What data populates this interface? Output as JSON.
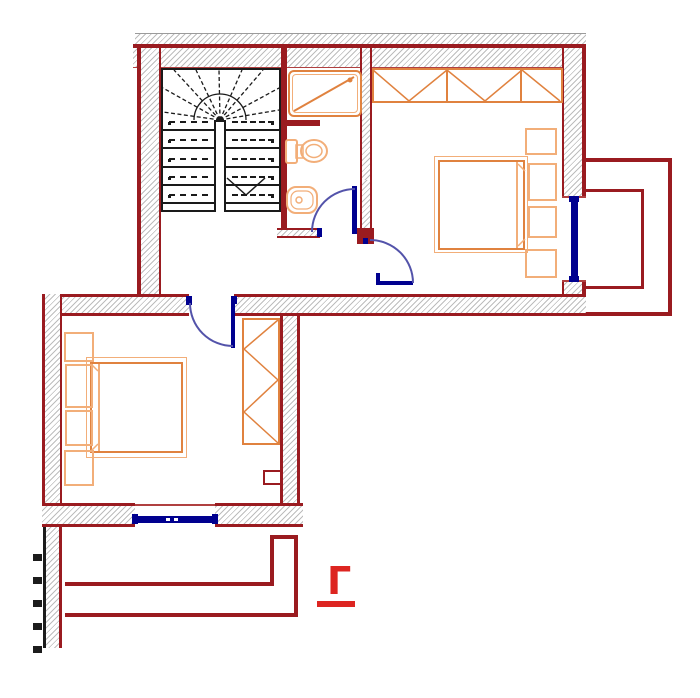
{
  "document": {
    "type": "architectural floor plan drawing",
    "visible_text": [
      "Г"
    ]
  },
  "section_marker": {
    "label": "Г"
  },
  "colors": {
    "wall": "#9a1b20",
    "accent_red": "#dd2521",
    "furniture": "#e0823f",
    "furniture_light": "#f2ae79",
    "window": "#00008f",
    "door_arc": "#5353aa",
    "hatch_line": "#bdbdbd",
    "stair": "#1a1a1a",
    "background": "#ffffff"
  },
  "stairs": {
    "treads_per_flight": 5,
    "flights": 2
  },
  "left_wall_ticks": 5,
  "elements": [
    "winder-staircase",
    "shower",
    "toilet",
    "bidet",
    "double-bed-top-right",
    "double-bed-bottom-left",
    "wardrobe-top",
    "wardrobe-side",
    "window-right",
    "window-bottom",
    "door-bathroom",
    "door-bedroom-right",
    "door-bedroom-bottom",
    "balcony-right",
    "balcony-bottom",
    "section-marker"
  ]
}
